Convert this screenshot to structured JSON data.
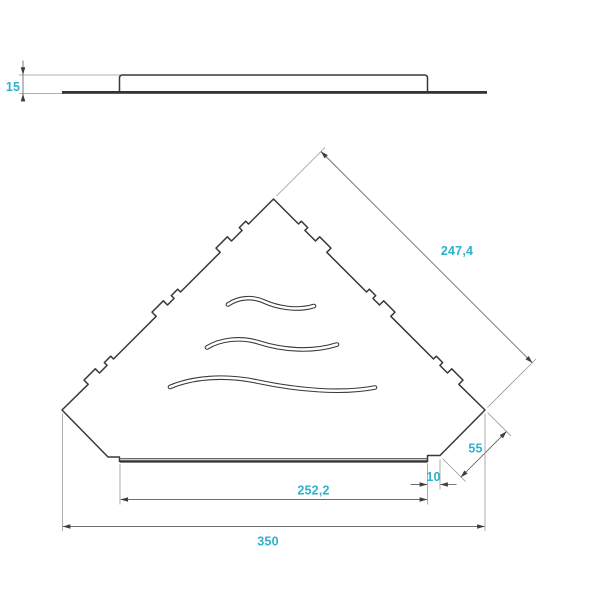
{
  "colors": {
    "background": "#ffffff",
    "accent_text": "#2eb1cc",
    "part_outline": "#383838",
    "dimension_lines": "#6d6d6d",
    "extension_lines": "#979797",
    "arrowheads": "#3f3f3f"
  },
  "dims": {
    "thickness": "15",
    "diagonal_edge": "247,4",
    "corner_cut": "55",
    "lip_inset": "10",
    "lip_width": "252,2",
    "overall_width": "350"
  }
}
